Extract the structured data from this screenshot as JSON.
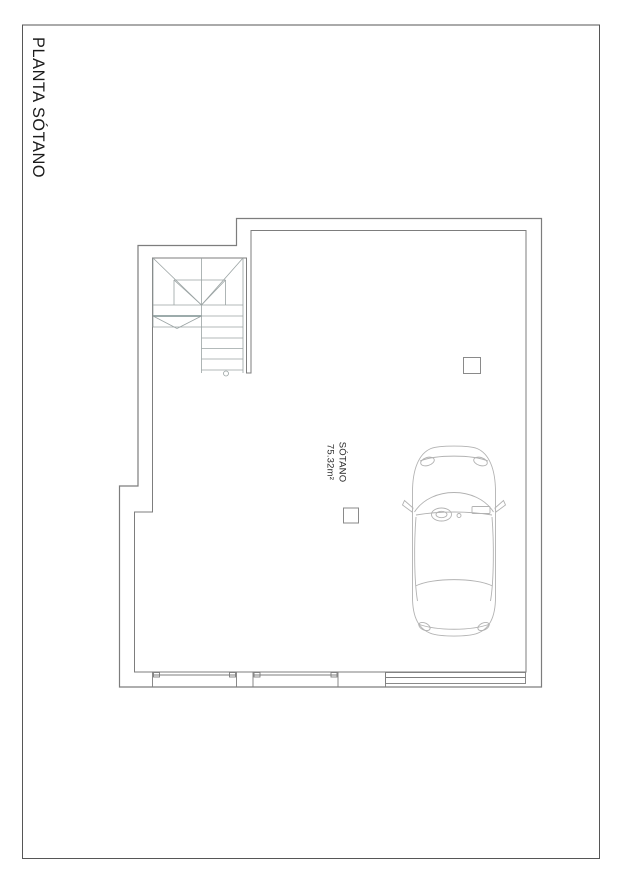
{
  "sheet": {
    "title": "PLANTA SÓTANO"
  },
  "plan": {
    "room_label": {
      "name": "SÓTANO",
      "area": "75.32m²"
    },
    "elements": [
      "staircase-u-shaped",
      "partition-wall",
      "column-square-upper",
      "column-square-lower",
      "window-bottom-left",
      "window-bottom-center",
      "garage-door-bottom-right",
      "car-top-view",
      "floor-drain-circle"
    ],
    "colors": {
      "sheet_border": "#565656",
      "wall_line": "#7d7d7d",
      "stair_line": "#9aa3a3",
      "stair_accent_tread": "#7c8f8f",
      "car_line": "#b2b2b2",
      "column_line": "#8a8a8a",
      "text": "#1b1b1b"
    }
  }
}
